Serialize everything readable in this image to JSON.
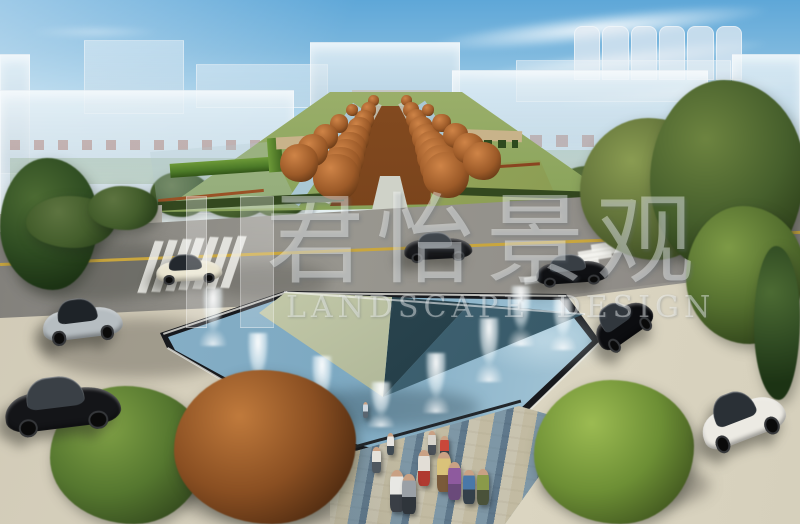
{
  "image": {
    "width_px": 800,
    "height_px": 524,
    "kind": "3D landscape-architecture rendering: bird's-eye view of a fountain plaza, faceted stone sculpture in a pool, tree-lined central axis, road with cars and translucent massing buildings"
  },
  "watermark": {
    "cjk_text": "君怡景观",
    "latin_text": "LANDSCAPE DESIGN",
    "color": "#ffffff"
  },
  "palette": {
    "sky_top": "#5ea7d8",
    "sky_horizon": "#eef4f2",
    "ghost_building": "#d6e2ea",
    "road_asphalt": "#8e8b86",
    "lane_line_yellow": "#c9a63e",
    "crosswalk_white": "#f4f4ef",
    "plaza_tile": "#d8d2bf",
    "plaza_joint": "#5f584c",
    "pool_water": "#86aec6",
    "pool_edging": "#17191d",
    "wedge_marble_light": "#c9cfae",
    "wedge_stone_dark": "#26404a",
    "wedge_stone_teal": "#3d6070",
    "fountain_spray": "#ffffff",
    "autumn_foliage": "#9c5a28",
    "green_foliage": "#55702f",
    "lawn": "#7c9a4e",
    "corten_edge": "#9a5226",
    "cobble_blue": "#7d96a5",
    "cobble_tan": "#c7bda0"
  },
  "scene": {
    "fountain_jets": [
      [
        213,
        288,
        58
      ],
      [
        258,
        333,
        60
      ],
      [
        322,
        356,
        58
      ],
      [
        381,
        382,
        45
      ],
      [
        436,
        353,
        60
      ],
      [
        489,
        318,
        64
      ],
      [
        521,
        286,
        60
      ],
      [
        563,
        298,
        52
      ]
    ],
    "axis_tree_rows": [
      {
        "x0": 336,
        "y0": 200,
        "d0": 46,
        "x1": 373,
        "y1": 106,
        "d1": 11,
        "count": 9
      },
      {
        "x0": 446,
        "y0": 198,
        "d0": 46,
        "x1": 406,
        "y1": 106,
        "d1": 11,
        "count": 9
      },
      {
        "x0": 299,
        "y0": 182,
        "d0": 38,
        "x1": 352,
        "y1": 116,
        "d1": 12,
        "count": 5
      },
      {
        "x0": 482,
        "y0": 180,
        "d0": 38,
        "x1": 428,
        "y1": 116,
        "d1": 12,
        "count": 5
      }
    ],
    "pedestrians": [
      [
        363,
        402,
        16,
        "#cfd8e0",
        "#5a6570"
      ],
      [
        387,
        433,
        22,
        "#e8e6e2",
        "#3f4a52"
      ],
      [
        428,
        431,
        24,
        "#d8d4cc",
        "#4a5058"
      ],
      [
        440,
        436,
        26,
        "#c9473a",
        "#3a4148"
      ],
      [
        418,
        450,
        36,
        "#e2ded6",
        "#b03a30"
      ],
      [
        437,
        452,
        40,
        "#d9c27a",
        "#7a5a3a"
      ],
      [
        448,
        462,
        38,
        "#8e5a9e",
        "#6a4a7a"
      ],
      [
        390,
        470,
        42,
        "#e8e8e4",
        "#3a3f46"
      ],
      [
        402,
        474,
        40,
        "#9aa0a6",
        "#2f353b"
      ],
      [
        372,
        447,
        26,
        "#e4e2da",
        "#4f585f"
      ],
      [
        463,
        470,
        34,
        "#4a78a8",
        "#34404a"
      ],
      [
        477,
        469,
        36,
        "#8a9a4a",
        "#4a523a"
      ]
    ],
    "cars": [
      {
        "x": 156,
        "y": 254,
        "w": 66,
        "h": 28,
        "rot": -3,
        "body": "#e9e4cf",
        "glass": "#23282e",
        "location": "road, left of center"
      },
      {
        "x": 404,
        "y": 232,
        "w": 68,
        "h": 28,
        "rot": -3,
        "body": "#191a1d",
        "glass": "#40464c",
        "location": "road, center"
      },
      {
        "x": 536,
        "y": 254,
        "w": 72,
        "h": 30,
        "rot": -4,
        "body": "#0f1013",
        "glass": "#383e44",
        "location": "road, right by crosswalk"
      },
      {
        "x": 42,
        "y": 298,
        "w": 80,
        "h": 42,
        "rot": -7,
        "body": "#b6bdc1",
        "glass": "#1e2328",
        "location": "left plaza"
      },
      {
        "x": 4,
        "y": 376,
        "w": 116,
        "h": 54,
        "rot": -7,
        "body": "#141518",
        "glass": "#3a4046",
        "location": "bottom-left plaza foreground"
      },
      {
        "x": 590,
        "y": 300,
        "w": 62,
        "h": 42,
        "rot": -35,
        "body": "#0c0d10",
        "glass": "#31373d",
        "location": "right plaza, upper"
      },
      {
        "x": 698,
        "y": 390,
        "w": 86,
        "h": 52,
        "rot": -21,
        "body": "#eceae3",
        "glass": "#2a3036",
        "location": "right plaza, lower"
      }
    ],
    "crosswalks": {
      "left": {
        "stripes": 7
      },
      "right": {
        "stripes": 8
      }
    }
  }
}
